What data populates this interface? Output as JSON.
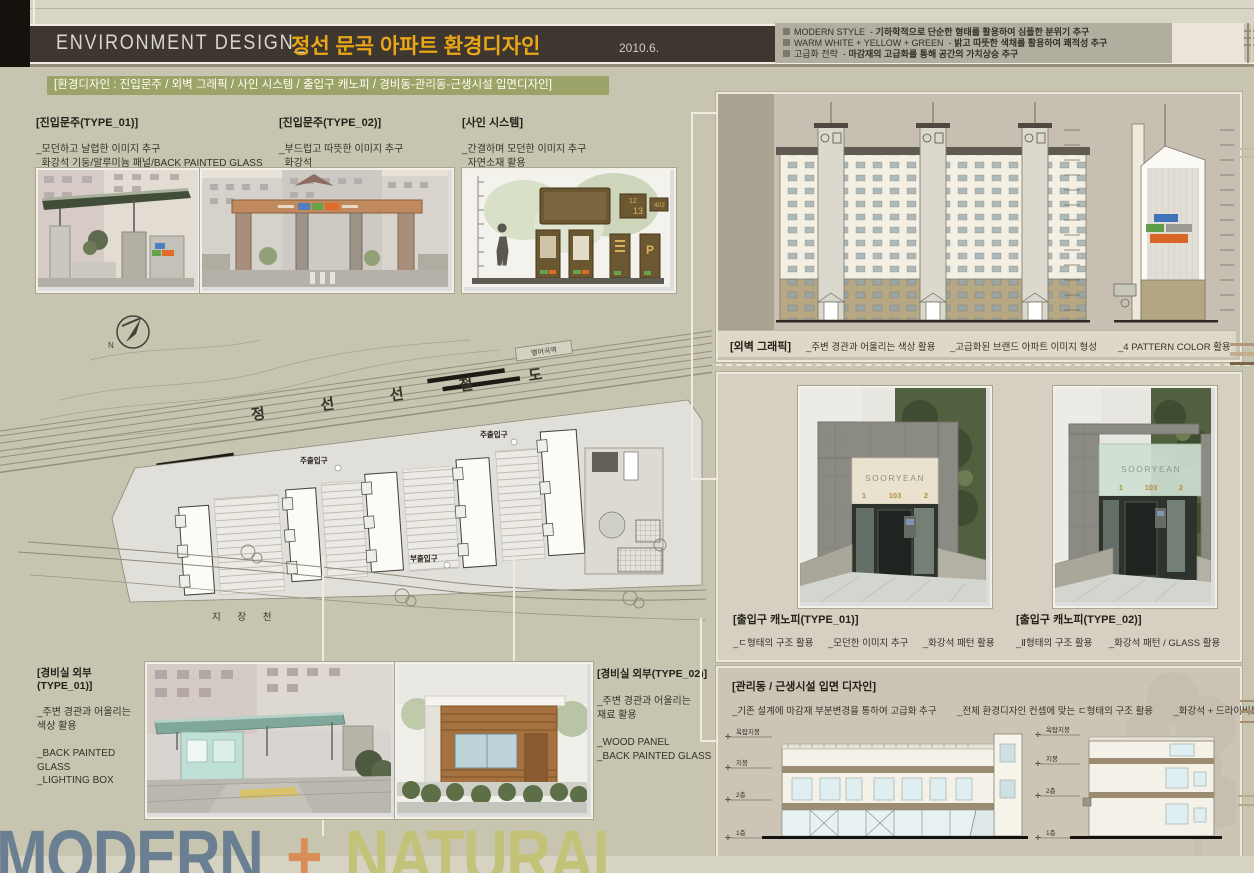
{
  "header": {
    "brand_en": "ENVIRONMENT DESIGN_",
    "brand_ko": "정선 문곡 아파트 환경디자인",
    "date": "2010.6.",
    "bullet_sep": "-",
    "bullets": [
      {
        "label": "MODERN STYLE",
        "desc": "기하학적으로 단순한 형태를 활용하여 심플한 분위기 추구"
      },
      {
        "label": "WARM WHITE + YELLOW + GREEN",
        "desc": "밝고 따뜻한 색채를 활용하여 쾌적성 추구"
      },
      {
        "label": "고급화 전략",
        "desc": "마감재의 고급화를 통해 공간의 가치상승 추구"
      }
    ]
  },
  "subtitle": "[환경디자인 : 진입문주 / 외벽 그래픽 / 사인 시스템 / 출입구 캐노피 / 경비동-관리동-근생시설 입면디자인]",
  "sections": {
    "entry1": {
      "title": "[진입문주(TYPE_01)]",
      "lines": [
        "_모던하고 날렵한 이미지 추구",
        "_화강석 기둥/알루미늄 패널/BACK PAINTED GLASS"
      ]
    },
    "entry2": {
      "title": "[진입문주(TYPE_02)]",
      "lines": [
        "_부드럽고 따뜻한 이미지 추구",
        "_화강석"
      ]
    },
    "sign": {
      "title": "[사인 시스템]",
      "lines": [
        "_간결하며 모던한 이미지 추구",
        "_자연소재 활용"
      ]
    },
    "wall_graphic": {
      "title": "[외벽 그래픽]",
      "captions": [
        "_주변 경관과 어울리는 색상 활용",
        "_고급화된 브랜드 아파트 이미지 형성",
        "_4 PATTERN COLOR 활용"
      ]
    },
    "canopy1": {
      "title": "[출입구 캐노피(TYPE_01)]",
      "captions": [
        "_ㄷ형태의 구조 활용",
        "_모던한 이미지 추구",
        "_화강석 패턴 활용"
      ]
    },
    "canopy2": {
      "title": "[출입구 캐노피(TYPE_02)]",
      "captions": [
        "_Ⅱ형태의 구조 활용",
        "_화강석 패턴 / GLASS 활용"
      ]
    },
    "guard1": {
      "title": "[경비실 외부(TYPE_01)]",
      "desc": [
        "_주변 경관과 어울리는",
        " 색상 활용"
      ],
      "materials": [
        "_BACK PAINTED GLASS",
        "_LIGHTING BOX"
      ]
    },
    "guard2": {
      "title": "[경비실 외부(TYPE_02)]",
      "desc": [
        "_주변 경관과 어울리는",
        " 재료 활용"
      ],
      "materials": [
        "_WOOD PANEL",
        "_BACK PAINTED GLASS"
      ]
    },
    "admin": {
      "title": "[관리동 / 근생시설 입면 디자인]",
      "captions": [
        "_기존 설계에 마감재 부분변경을 통하여 고급화 추구",
        "_전체 환경디자인 컨셉에 맞는 ㄷ형태의 구조 활용",
        "_화강석 + 드라이비트"
      ]
    }
  },
  "site_plan": {
    "railway": "정 선 선 철 도",
    "station": "별어곡역",
    "stream": "지 장 천",
    "main_gate": "주출입구",
    "sub_gate": "부출입구",
    "north": "N"
  },
  "sign_board": {
    "num_a": "12",
    "num_b": "13",
    "num_c": "402",
    "p": "P"
  },
  "canopy_render": {
    "name": "SOORYEAN",
    "unit_left": "1",
    "unit_center": "103",
    "unit_right": "2"
  },
  "admin_levels": [
    "옥탑지붕",
    "지붕",
    "2층",
    "1층"
  ],
  "footer": {
    "word1": "MODERN",
    "plus": "+",
    "word2": "NATURAL"
  },
  "colors": {
    "accent_yellow": "#eaa616",
    "olive_bar": "#9ca368",
    "modern_blue": "#6b7f92",
    "plus_orange": "#d98e57",
    "natural_green": "#c2c378"
  }
}
